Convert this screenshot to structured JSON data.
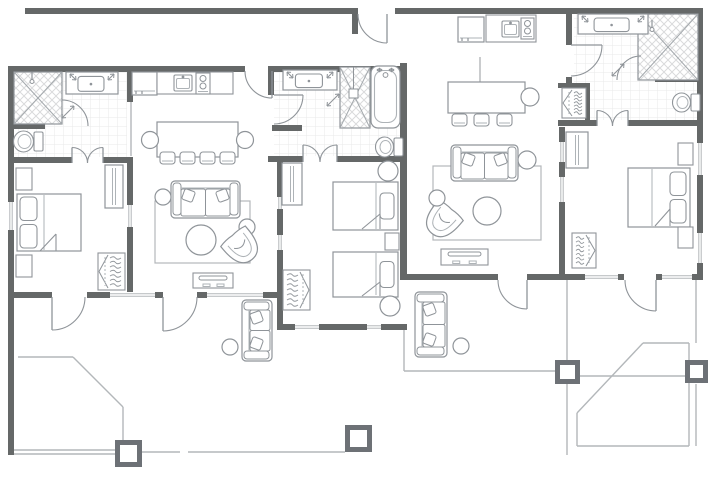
{
  "floorplan": {
    "canvas": {
      "w": 720,
      "h": 480,
      "bg": "#ffffff"
    },
    "colors": {
      "wall": "#656868",
      "furniture": "#8f9499",
      "furniture_light": "#aeb3b7",
      "door": "#8f9499",
      "window_line": "#b3b7ba",
      "patio_line": "#b3b7ba",
      "tile_line": "#e9eaea",
      "hatch_line": "#d9dadb",
      "shower_x": "#a4a9ad",
      "post": "#6d7176"
    },
    "walls": [
      [
        25,
        8,
        330,
        6
      ],
      [
        352,
        8,
        6,
        26
      ],
      [
        395,
        8,
        308,
        6
      ],
      [
        697,
        8,
        6,
        272
      ],
      [
        400,
        63,
        7,
        217
      ],
      [
        8,
        66,
        6,
        231
      ],
      [
        8,
        66,
        237,
        6
      ],
      [
        272,
        66,
        128,
        6
      ],
      [
        127,
        66,
        6,
        36
      ],
      [
        8,
        157,
        64,
        6
      ],
      [
        103,
        157,
        30,
        6
      ],
      [
        127,
        157,
        6,
        140
      ],
      [
        8,
        292,
        44,
        6
      ],
      [
        87,
        292,
        76,
        6
      ],
      [
        197,
        292,
        80,
        6
      ],
      [
        8,
        297,
        6,
        158
      ],
      [
        268,
        66,
        6,
        29
      ],
      [
        272,
        125,
        30,
        6
      ],
      [
        268,
        156,
        35,
        6
      ],
      [
        337,
        156,
        63,
        6
      ],
      [
        277,
        157,
        6,
        173
      ],
      [
        277,
        324,
        130,
        6
      ],
      [
        10,
        124,
        35,
        5
      ],
      [
        559,
        127,
        6,
        153
      ],
      [
        566,
        14,
        6,
        31
      ],
      [
        566,
        77,
        6,
        6
      ],
      [
        558,
        83,
        32,
        5
      ],
      [
        585,
        83,
        5,
        42
      ],
      [
        558,
        120,
        39,
        6
      ],
      [
        628,
        120,
        75,
        6
      ],
      [
        655,
        77,
        43,
        5
      ],
      [
        400,
        274,
        98,
        6
      ],
      [
        527,
        274,
        97,
        6
      ],
      [
        656,
        274,
        47,
        6
      ]
    ],
    "windows": [
      [
        8,
        202,
        6,
        28,
        "v"
      ],
      [
        110,
        292,
        45,
        6,
        "h"
      ],
      [
        207,
        292,
        56,
        6,
        "h"
      ],
      [
        127,
        205,
        6,
        22,
        "v"
      ],
      [
        277,
        197,
        6,
        12,
        "v"
      ],
      [
        277,
        235,
        6,
        15,
        "v"
      ],
      [
        295,
        324,
        24,
        6,
        "h"
      ],
      [
        367,
        324,
        14,
        6,
        "h"
      ],
      [
        559,
        142,
        6,
        20,
        "v"
      ],
      [
        559,
        177,
        6,
        25,
        "v"
      ],
      [
        585,
        274,
        33,
        6,
        "h"
      ],
      [
        662,
        274,
        30,
        6,
        "h"
      ],
      [
        697,
        143,
        6,
        32,
        "v"
      ],
      [
        697,
        233,
        6,
        30,
        "v"
      ]
    ],
    "tiles": [
      [
        14,
        72,
        113,
        85
      ],
      [
        274,
        72,
        126,
        84
      ],
      [
        574,
        14,
        123,
        106
      ]
    ],
    "doors": [
      {
        "cx": 387,
        "cy": 14,
        "r": 29,
        "a1": 180,
        "a2": 90,
        "sweep": 0,
        "leaf": "a2",
        "n": "front-entry-door"
      },
      {
        "cx": 272,
        "cy": 71,
        "r": 27,
        "a1": 180,
        "a2": 90,
        "sweep": 0,
        "leaf": "a2",
        "n": "unit1-entry-door"
      },
      {
        "cx": 274,
        "cy": 95,
        "r": 29,
        "a1": 0,
        "a2": 90,
        "sweep": 1,
        "leaf": "a1",
        "n": "bath2-door"
      },
      {
        "cx": 571,
        "cy": 45,
        "r": 31,
        "a1": 0,
        "a2": 90,
        "sweep": 1,
        "leaf": "a1",
        "n": "bath3-door"
      },
      {
        "cx": 52,
        "cy": 297,
        "r": 33,
        "a1": 0,
        "a2": 90,
        "sweep": 1,
        "leaf": "a2",
        "n": "bedroom1-patio-door"
      },
      {
        "cx": 163,
        "cy": 297,
        "r": 34,
        "a1": 0,
        "a2": 90,
        "sweep": 1,
        "leaf": "a2",
        "n": "living1-patio-door"
      },
      {
        "cx": 527,
        "cy": 280,
        "r": 29,
        "a1": 180,
        "a2": 90,
        "sweep": 0,
        "leaf": "a2",
        "n": "living2-patio-door"
      },
      {
        "cx": 656,
        "cy": 280,
        "r": 31,
        "a1": 180,
        "a2": 90,
        "sweep": 0,
        "leaf": "a2",
        "n": "bedroom3-patio-door"
      },
      {
        "cx": 72,
        "cy": 163,
        "r": 15.5,
        "a1": 270,
        "a2": 0,
        "sweep": 1,
        "leaf": "a1",
        "n": "bath1-double-door-left"
      },
      {
        "cx": 103,
        "cy": 163,
        "r": 15.5,
        "a1": 180,
        "a2": 270,
        "sweep": 1,
        "leaf": "a2",
        "n": "bath1-double-door-right"
      },
      {
        "cx": 303,
        "cy": 162,
        "r": 17,
        "a1": 270,
        "a2": 0,
        "sweep": 1,
        "leaf": "a1",
        "n": "bath2-double-door-left"
      },
      {
        "cx": 337,
        "cy": 162,
        "r": 17,
        "a1": 180,
        "a2": 270,
        "sweep": 1,
        "leaf": "a2",
        "n": "bath2-double-door-right"
      },
      {
        "cx": 597,
        "cy": 126,
        "r": 15.5,
        "a1": 270,
        "a2": 0,
        "sweep": 1,
        "leaf": "a1",
        "n": "bath3-double-door-left"
      },
      {
        "cx": 628,
        "cy": 126,
        "r": 15.5,
        "a1": 180,
        "a2": 270,
        "sweep": 1,
        "leaf": "a2",
        "n": "bath3-double-door-right"
      }
    ],
    "showers": [
      {
        "n": "bath1-shower",
        "x": 14,
        "y": 72,
        "w": 48,
        "h": 52,
        "head": [
          32,
          72
        ],
        "door": {
          "cx": 62,
          "cy": 126,
          "r": 26,
          "a1": 270,
          "a2": 0,
          "sweep": 1
        },
        "handle": [
          62,
          118,
          74,
          106
        ]
      },
      {
        "n": "bath2-shower",
        "x": 340,
        "y": 67,
        "w": 30,
        "h": 61,
        "headrect": [
          349,
          89,
          9,
          9
        ],
        "handle": [
          327,
          106,
          339,
          94
        ]
      },
      {
        "n": "bath3-shower",
        "x": 638,
        "y": 14,
        "w": 60,
        "h": 66,
        "head": [
          652,
          20
        ],
        "door": {
          "cx": 641,
          "cy": 80,
          "r": 24,
          "a1": 270,
          "a2": 180,
          "sweep": 0
        },
        "handle": [
          612,
          76,
          624,
          64
        ]
      }
    ],
    "light_lines": [
      [
        131,
        102,
        131,
        156
      ],
      [
        480,
        57,
        480,
        82
      ],
      [
        13,
        450,
        115,
        450
      ],
      [
        13,
        454,
        115,
        454
      ],
      [
        142,
        452,
        180,
        452
      ],
      [
        188,
        452,
        345,
        452
      ],
      [
        18,
        357,
        73,
        357
      ],
      [
        73,
        357,
        123,
        407
      ],
      [
        123,
        407,
        123,
        441
      ],
      [
        404,
        330,
        404,
        371
      ],
      [
        404,
        371,
        555,
        371
      ],
      [
        567,
        280,
        567,
        360
      ],
      [
        567,
        384,
        567,
        455
      ],
      [
        580,
        376,
        685,
        376
      ],
      [
        696,
        280,
        696,
        343
      ],
      [
        696,
        384,
        696,
        446
      ],
      [
        643,
        343,
        689,
        343
      ],
      [
        577,
        413,
        643,
        343
      ],
      [
        577,
        413,
        577,
        446
      ],
      [
        577,
        446,
        689,
        446
      ],
      [
        689,
        343,
        689,
        446
      ]
    ],
    "posts": [
      [
        115,
        440,
        27,
        27
      ],
      [
        345,
        425,
        27,
        27
      ],
      [
        555,
        360,
        25,
        24
      ],
      [
        685,
        360,
        23,
        23
      ]
    ],
    "furniture": [
      {
        "t": "vanity",
        "n": "bath1-vanity",
        "x": 66,
        "y": 72,
        "w": 52,
        "h": 22
      },
      {
        "t": "toilet",
        "n": "bath1-toilet",
        "x": 13,
        "y": 130,
        "w": 30,
        "h": 23
      },
      {
        "t": "fridge",
        "n": "kitchen1-fridge",
        "x": 132,
        "y": 72,
        "w": 25,
        "h": 23
      },
      {
        "t": "counter",
        "n": "kitchen1-counter",
        "x": 157,
        "y": 72,
        "w": 76,
        "h": 22
      },
      {
        "t": "ksink",
        "n": "kitchen1-sink",
        "x": 174,
        "y": 75,
        "w": 18,
        "h": 16
      },
      {
        "t": "stove",
        "n": "kitchen1-stove",
        "x": 196,
        "y": 73,
        "w": 14,
        "h": 21
      },
      {
        "t": "table",
        "n": "dining1-table",
        "x": 157,
        "y": 122,
        "w": 81,
        "h": 35
      },
      {
        "t": "circle",
        "n": "dining1-end-chair",
        "cx": 150,
        "cy": 140,
        "r": 8.5
      },
      {
        "t": "circle",
        "n": "dining1-end-chair",
        "cx": 245,
        "cy": 140,
        "r": 8.5
      },
      {
        "t": "chair",
        "n": "dining1-chair",
        "x": 160,
        "y": 152
      },
      {
        "t": "chair",
        "n": "dining1-chair",
        "x": 180,
        "y": 152
      },
      {
        "t": "chair",
        "n": "dining1-chair",
        "x": 200,
        "y": 152
      },
      {
        "t": "chair",
        "n": "dining1-chair",
        "x": 220,
        "y": 152
      },
      {
        "t": "rug",
        "n": "living1-rug",
        "x": 155,
        "y": 201,
        "w": 95,
        "h": 62
      },
      {
        "t": "sofa",
        "n": "living1-sofa",
        "x": 171,
        "y": 181,
        "w": 69,
        "h": 37
      },
      {
        "t": "circle",
        "n": "side-table",
        "cx": 163,
        "cy": 197,
        "r": 8
      },
      {
        "t": "circle",
        "n": "side-table",
        "cx": 247,
        "cy": 227,
        "r": 8
      },
      {
        "t": "circle",
        "n": "living1-coffee-table",
        "cx": 201,
        "cy": 240,
        "r": 15
      },
      {
        "t": "armchair",
        "n": "living1-armchair",
        "cx": 242,
        "cy": 247,
        "rot": -40
      },
      {
        "t": "tv",
        "n": "living1-tv-console",
        "x": 193,
        "y": 273,
        "w": 40,
        "h": 15
      },
      {
        "t": "nightstand",
        "n": "nightstand",
        "x": 16,
        "y": 168,
        "w": 16,
        "h": 22
      },
      {
        "t": "nightstand",
        "n": "nightstand",
        "x": 16,
        "y": 255,
        "w": 16,
        "h": 22
      },
      {
        "t": "bed",
        "n": "bedroom1-bed",
        "x": 17,
        "y": 194,
        "w": 64,
        "h": 57,
        "head": "left",
        "pillows": 2,
        "fold": [
          40,
          251,
          56,
          234
        ],
        "sheet": [
          44,
          195,
          250
        ]
      },
      {
        "t": "dresser",
        "n": "bedroom1-dresser",
        "x": 105,
        "y": 165,
        "w": 18,
        "h": 43
      },
      {
        "t": "closet",
        "n": "bedroom1-closet",
        "x": 98,
        "y": 253,
        "w": 27,
        "h": 37,
        "dir": "left"
      },
      {
        "t": "vanity",
        "n": "bath2-vanity",
        "x": 283,
        "y": 70,
        "w": 54,
        "h": 20
      },
      {
        "t": "tub",
        "n": "bath2-tub",
        "x": 371,
        "y": 66,
        "w": 29,
        "h": 62
      },
      {
        "t": "toilet",
        "n": "bath2-toilet",
        "x": 375,
        "y": 136,
        "w": 28,
        "h": 22
      },
      {
        "t": "dresser",
        "n": "bedroom2-dresser",
        "x": 282,
        "y": 163,
        "w": 20,
        "h": 42
      },
      {
        "t": "bed",
        "n": "bedroom2-bed-a",
        "x": 333,
        "y": 182,
        "w": 65,
        "h": 48,
        "head": "right",
        "pillows": 1,
        "fold": [
          362,
          229,
          380,
          214
        ],
        "sheet": [
          376,
          183,
          229
        ]
      },
      {
        "t": "bed",
        "n": "bedroom2-bed-b",
        "x": 333,
        "y": 252,
        "w": 65,
        "h": 45,
        "head": "right",
        "pillows": 1,
        "fold": [
          362,
          296,
          380,
          282
        ],
        "sheet": [
          376,
          253,
          295
        ]
      },
      {
        "t": "circle",
        "n": "side-table",
        "cx": 388,
        "cy": 171,
        "r": 10
      },
      {
        "t": "nightstand",
        "n": "nightstand",
        "x": 385,
        "y": 233,
        "w": 14,
        "h": 17
      },
      {
        "t": "circle",
        "n": "side-table",
        "cx": 390,
        "cy": 306,
        "r": 10
      },
      {
        "t": "closet",
        "n": "bedroom2-closet",
        "x": 283,
        "y": 270,
        "w": 27,
        "h": 40,
        "dir": "right"
      },
      {
        "t": "fridge",
        "n": "kitchen2-fridge",
        "x": 458,
        "y": 17,
        "w": 26,
        "h": 25
      },
      {
        "t": "counter",
        "n": "kitchen2-counter",
        "x": 486,
        "y": 15,
        "w": 50,
        "h": 27
      },
      {
        "t": "ksink",
        "n": "kitchen2-sink",
        "x": 502,
        "y": 21,
        "w": 17,
        "h": 16
      },
      {
        "t": "stove",
        "n": "kitchen2-stove",
        "x": 521,
        "y": 18,
        "w": 13,
        "h": 21
      },
      {
        "t": "table",
        "n": "dining2-table",
        "x": 448,
        "y": 82,
        "w": 77,
        "h": 31
      },
      {
        "t": "circle",
        "n": "dining2-end-chair",
        "cx": 530,
        "cy": 97,
        "r": 9
      },
      {
        "t": "chair",
        "n": "dining2-chair",
        "x": 452,
        "y": 114
      },
      {
        "t": "chair",
        "n": "dining2-chair",
        "x": 474,
        "y": 114
      },
      {
        "t": "chair",
        "n": "dining2-chair",
        "x": 497,
        "y": 114
      },
      {
        "t": "rug",
        "n": "living2-rug",
        "x": 433,
        "y": 166,
        "w": 108,
        "h": 74
      },
      {
        "t": "sofa",
        "n": "living2-sofa",
        "x": 451,
        "y": 145,
        "w": 67,
        "h": 36
      },
      {
        "t": "circle",
        "n": "side-table",
        "cx": 527,
        "cy": 160,
        "r": 9
      },
      {
        "t": "circle",
        "n": "living2-coffee-table",
        "cx": 487,
        "cy": 211,
        "r": 14
      },
      {
        "t": "armchair",
        "n": "living2-armchair",
        "cx": 442,
        "cy": 221,
        "rot": 40
      },
      {
        "t": "circle",
        "n": "side-table",
        "cx": 437,
        "cy": 198,
        "r": 8
      },
      {
        "t": "tv",
        "n": "living2-tv-console",
        "x": 441,
        "y": 249,
        "w": 47,
        "h": 16
      },
      {
        "t": "closet",
        "n": "hall-closet",
        "x": 562,
        "y": 88,
        "w": 24,
        "h": 30,
        "dir": "left"
      },
      {
        "t": "vanity",
        "n": "bath3-vanity",
        "x": 578,
        "y": 14,
        "w": 70,
        "h": 20
      },
      {
        "t": "toilet",
        "n": "bath3-toilet",
        "x": 672,
        "y": 92,
        "w": 28,
        "h": 21
      },
      {
        "t": "dresser",
        "n": "bedroom3-dresser",
        "x": 566,
        "y": 132,
        "w": 22,
        "h": 36
      },
      {
        "t": "bed",
        "n": "bedroom3-bed",
        "x": 628,
        "y": 168,
        "w": 62,
        "h": 59,
        "head": "right",
        "pillows": 2,
        "fold": [
          655,
          226,
          670,
          209
        ],
        "sheet": [
          652,
          169,
          226
        ]
      },
      {
        "t": "nightstand",
        "n": "nightstand",
        "x": 678,
        "y": 143,
        "w": 15,
        "h": 22
      },
      {
        "t": "nightstand",
        "n": "nightstand",
        "x": 678,
        "y": 227,
        "w": 15,
        "h": 21
      },
      {
        "t": "closet",
        "n": "bedroom3-closet",
        "x": 572,
        "y": 233,
        "w": 24,
        "h": 35,
        "dir": "right"
      },
      {
        "t": "sofa",
        "n": "patio1-sofa",
        "x": 226.5,
        "y": 315.5,
        "w": 61,
        "h": 30,
        "rot": -90
      },
      {
        "t": "circle",
        "n": "patio1-side-table",
        "cx": 230,
        "cy": 347,
        "r": 8
      },
      {
        "t": "sofa",
        "n": "patio2-sofa",
        "x": 398.5,
        "y": 308.5,
        "w": 65,
        "h": 32,
        "rot": -90
      },
      {
        "t": "circle",
        "n": "patio2-side-table",
        "cx": 461,
        "cy": 346,
        "r": 8
      }
    ]
  }
}
